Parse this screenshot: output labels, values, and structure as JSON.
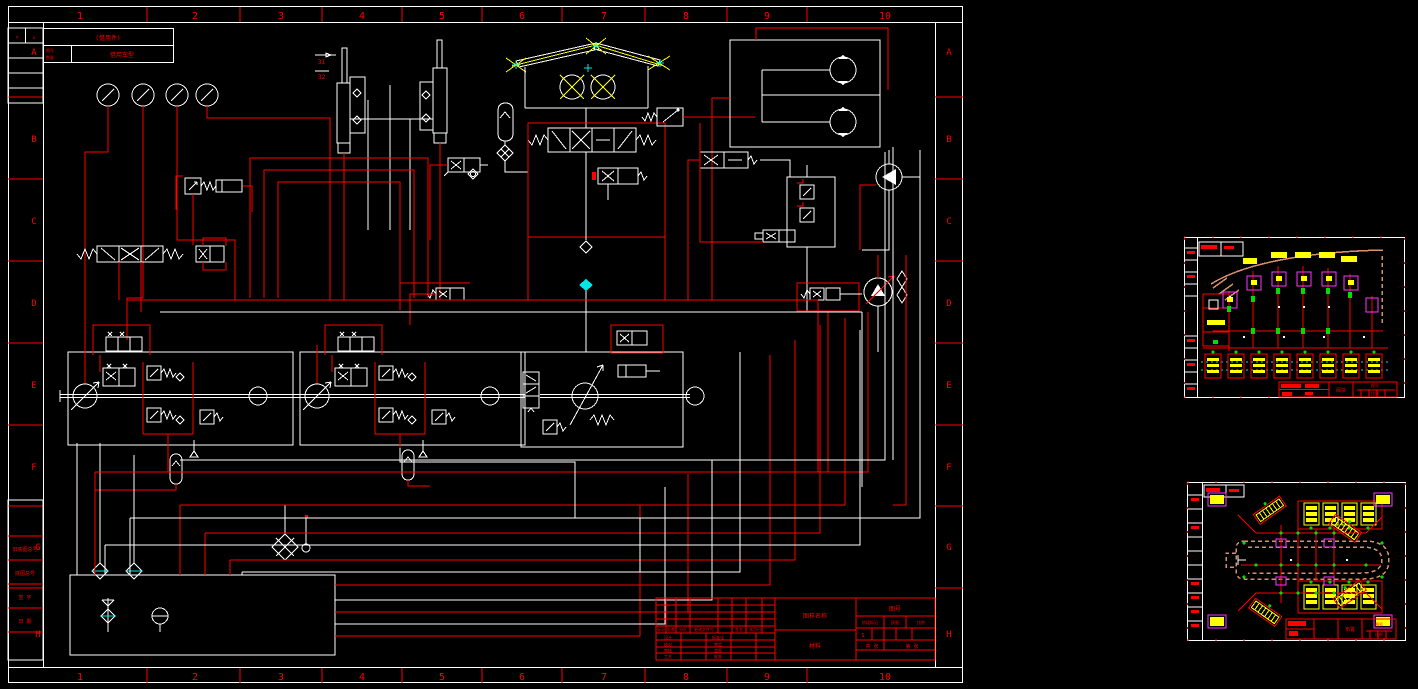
{
  "window": {
    "background": "#000000"
  },
  "palette": {
    "line_red": "#ff0000",
    "line_white": "#ffffff",
    "accent_yellow": "#ffff00",
    "accent_cyan": "#00e5e5",
    "accent_green": "#00dd00",
    "accent_magenta": "#ff35ff",
    "vehicle_outline": "#d98f6c"
  },
  "main_sheet": {
    "zone_columns": [
      "1",
      "2",
      "3",
      "4",
      "5",
      "6",
      "7",
      "8",
      "9",
      "10"
    ],
    "zone_rows": [
      "A",
      "B",
      "C",
      "D",
      "E",
      "F",
      "G",
      "H"
    ],
    "borrow_block": {
      "title": "(借用件)",
      "col_label_1": "图号",
      "col_label_2": "数量",
      "col_label_3": "借用车型"
    },
    "margin_blocks": {
      "arrow_up": "↑",
      "arrow_down": "↓",
      "labels": [
        "旧底图总号",
        "底图总号",
        "签 字",
        "日 期"
      ]
    },
    "component_labels": {
      "cylinder_1": "31",
      "cylinder_2": "32"
    },
    "title_block": {
      "name_cell": "图样名称",
      "material_cell": "材料",
      "drawing_no_cell": "图号",
      "stage_label": "阶段标记",
      "weight_label": "质量",
      "scale_label": "比例",
      "scale_value": "S",
      "sheet_total": "共 张",
      "sheet_no": "第 张",
      "rev_header": [
        "标记",
        "处数",
        "分区",
        "更改文件号",
        "签名",
        "年月日"
      ],
      "sign_rows": [
        [
          "设计",
          "标准化"
        ],
        [
          "校对",
          "审定"
        ],
        [
          "审核",
          "会签"
        ],
        [
          "工艺",
          "批准"
        ]
      ],
      "date_label": "日期"
    }
  },
  "mini_sheet_1": {
    "title_cell": "阀块",
    "no_label": "图号",
    "scale_label": "比例"
  },
  "mini_sheet_2": {
    "title_cell": "布置",
    "no_label": "图号",
    "scale_label": "比例"
  }
}
